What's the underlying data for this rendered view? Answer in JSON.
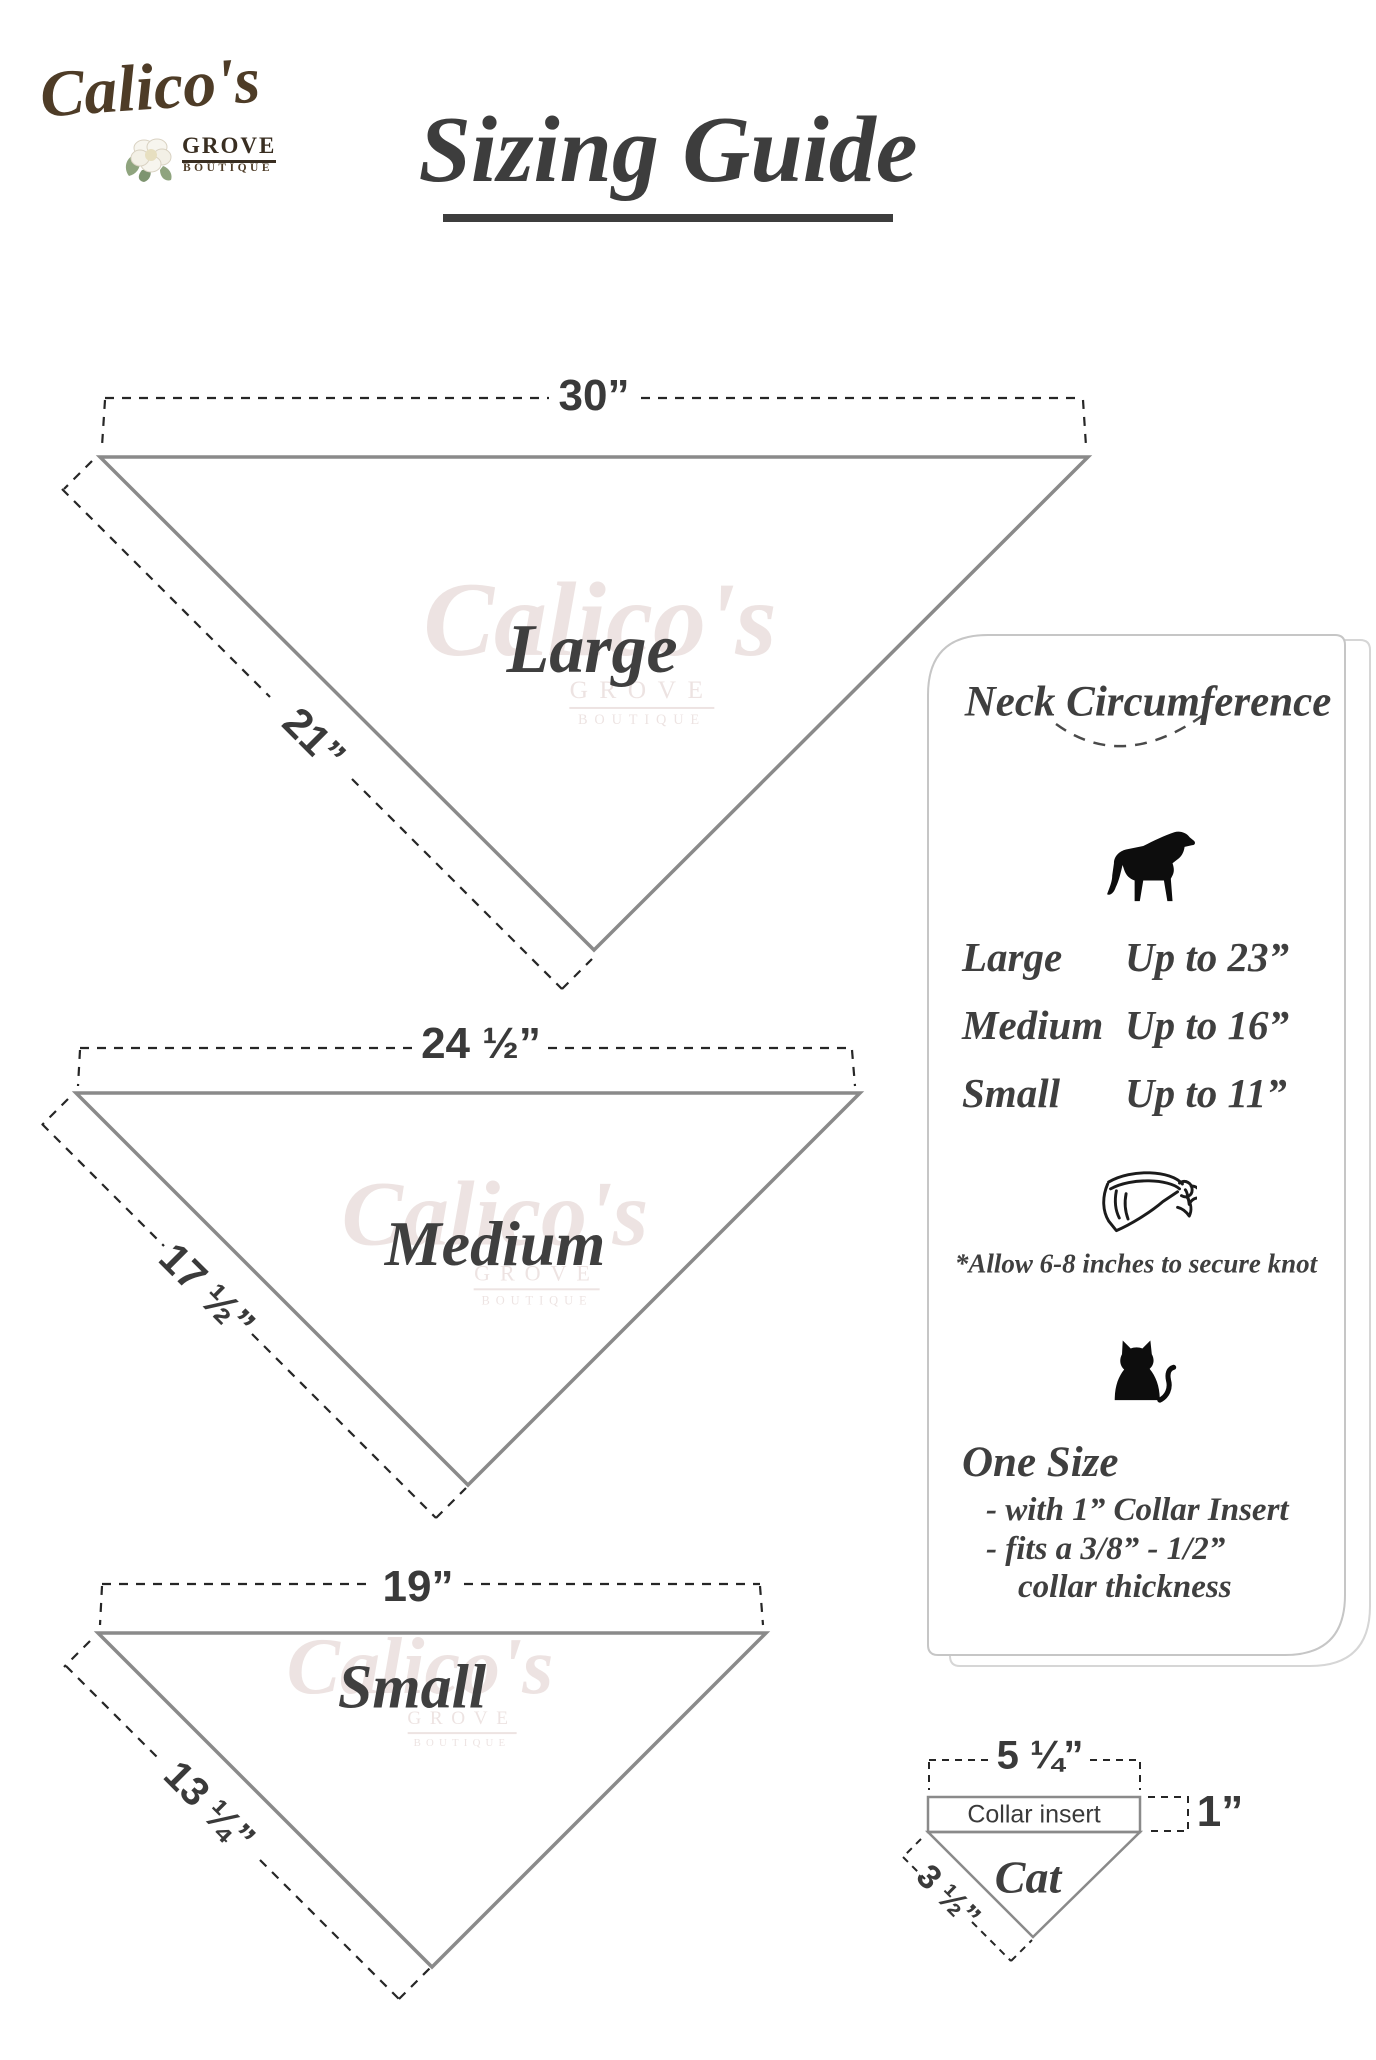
{
  "logo": {
    "name": "Calico's",
    "grove": "GROVE",
    "boutique": "BOUTIQUE"
  },
  "title": "Sizing Guide",
  "watermark": {
    "name": "Calico's",
    "grove": "GROVE",
    "boutique": "BOUTIQUE"
  },
  "bandanas": [
    {
      "label": "Large",
      "top_width": "30”",
      "side_length": "21”"
    },
    {
      "label": "Medium",
      "top_width": "24 ½”",
      "side_length": "17 ½”"
    },
    {
      "label": "Small",
      "top_width": "19”",
      "side_length": "13 ¼”"
    }
  ],
  "panel": {
    "heading": "Neck Circumference",
    "dog_icon": "dog-silhouette",
    "sizes": [
      {
        "label": "Large",
        "value": "Up to 23”"
      },
      {
        "label": "Medium",
        "value": "Up to 16”"
      },
      {
        "label": "Small",
        "value": "Up to 11”"
      }
    ],
    "bandana_icon": "tied-bandana-outline",
    "knot_note": "*Allow 6-8 inches to secure knot",
    "cat_icon": "cat-silhouette",
    "one_size_heading": "One Size",
    "one_size_details": [
      "- with 1” Collar Insert",
      "- fits a 3/8” - 1/2”",
      "collar thickness"
    ]
  },
  "cat_diagram": {
    "top_width": "5 ¼”",
    "insert_label": "Collar insert",
    "insert_height": "1”",
    "side_length": "3 ½”",
    "label": "Cat"
  },
  "colors": {
    "line_gray": "#8a8a8a",
    "dash_dark": "#262626",
    "text_dark": "#3a3a3a",
    "logo_brown": "#4e3c27",
    "panel_border": "#c6c6c6",
    "watermark_pink": "#cbb0ab"
  }
}
